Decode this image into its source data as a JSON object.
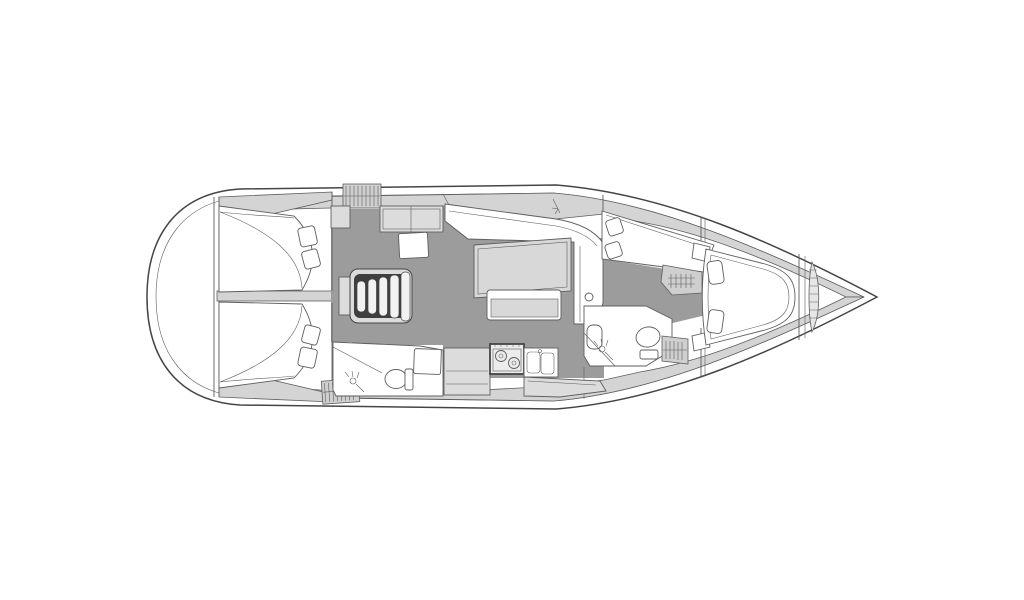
{
  "page": {
    "background": "#ffffff",
    "kind": "sailboat-interior-floor-plan",
    "orientation": "bow-right"
  },
  "colors": {
    "white": "#ffffff",
    "outline": "#5e5e5e",
    "outline_dark": "#454545",
    "deck": "#d4d4d4",
    "furniture": "#dcdcdc",
    "table": "#d8d8d8",
    "floor": "#9c9c9c",
    "hatch": "#cfcfcf",
    "steps_well": "#3f3f3f",
    "stove_face": "#ececec"
  },
  "plan": {
    "areas": [
      {
        "id": "stern-transom",
        "label": "stern transom"
      },
      {
        "id": "aft-cabin-port",
        "label": "aft double-berth cabin (port)"
      },
      {
        "id": "aft-cabin-starboard",
        "label": "aft double-berth cabin (starboard)"
      },
      {
        "id": "aft-head",
        "label": "aft head with shower, toilet and shower pan"
      },
      {
        "id": "companionway-steps",
        "label": "companionway steps"
      },
      {
        "id": "salon",
        "label": "salon with U-settee, table and bench"
      },
      {
        "id": "galley",
        "label": "galley with counter, two-burner stove and double sink"
      },
      {
        "id": "forward-cabin-port",
        "label": "forward double-berth cabin (port)"
      },
      {
        "id": "forward-head",
        "label": "forward head with sink, shower and toilet"
      },
      {
        "id": "bow-cabin",
        "label": "bow owner cabin with island berth"
      },
      {
        "id": "anchor-locker",
        "label": "anchor locker"
      }
    ]
  }
}
